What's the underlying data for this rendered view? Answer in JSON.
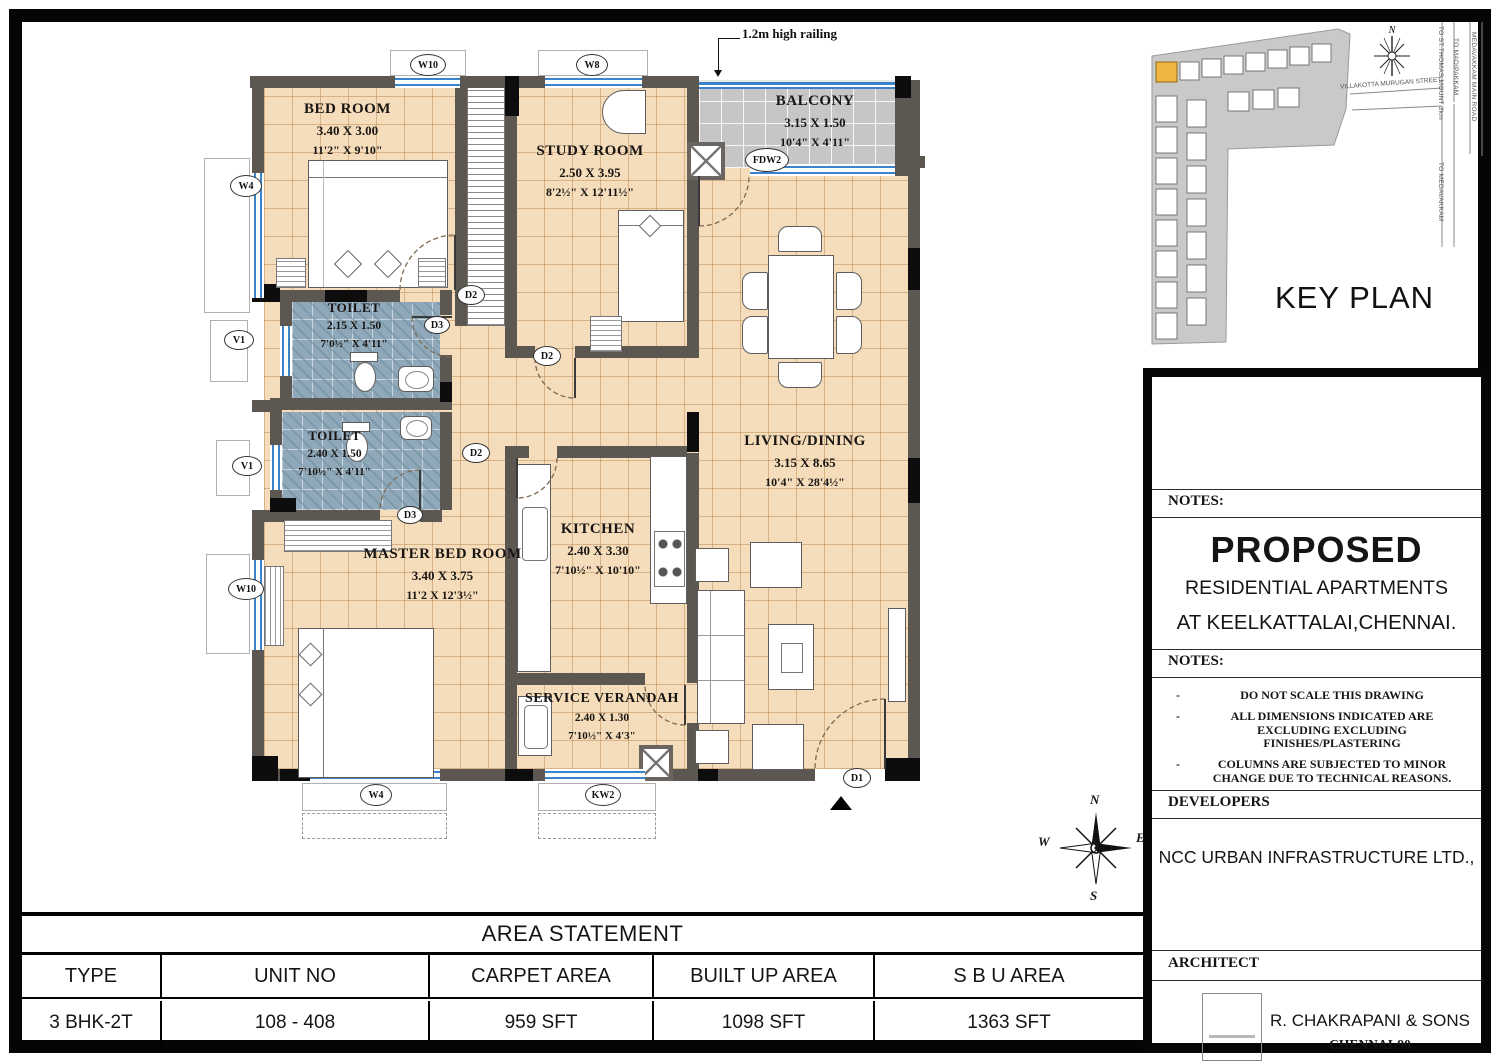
{
  "palette": {
    "floor": "#f5dcbb",
    "toilet_floor": "#8fa9ba",
    "balcony_floor": "#c6c6c6",
    "wall": "#5d5752",
    "window_blue": "#3b84c9",
    "keyplan_highlight": "#f0b440"
  },
  "plan": {
    "railing_note": "1.2m high railing",
    "rooms": {
      "bedroom": {
        "name": "BED ROOM",
        "m": "3.40 X 3.00",
        "ft": "11'2\" X 9'10\""
      },
      "study": {
        "name": "STUDY ROOM",
        "m": "2.50 X 3.95",
        "ft": "8'2½\" X 12'11½\""
      },
      "balcony": {
        "name": "BALCONY",
        "m": "3.15 X 1.50",
        "ft": "10'4\" X 4'11\""
      },
      "toilet1": {
        "name": "TOILET",
        "m": "2.15 X 1.50",
        "ft": "7'0½\" X 4'11\""
      },
      "toilet2": {
        "name": "TOILET",
        "m": "2.40 X 1.50",
        "ft": "7'10½\" X 4'11\""
      },
      "master": {
        "name": "MASTER BED ROOM",
        "m": "3.40 X 3.75",
        "ft": "11'2 X 12'3½\""
      },
      "kitchen": {
        "name": "KITCHEN",
        "m": "2.40 X 3.30",
        "ft": "7'10½\" X 10'10\""
      },
      "verandah": {
        "name": "SERVICE VERANDAH",
        "m": "2.40 X 1.30",
        "ft": "7'10½\" X 4'3\""
      },
      "living": {
        "name": "LIVING/DINING",
        "m": "3.15 X 8.65",
        "ft": "10'4\" X 28'4½\""
      }
    },
    "markers": {
      "w10": "W10",
      "w8": "W8",
      "w4": "W4",
      "v1": "V1",
      "kw2": "KW2",
      "fdw2": "FDW2",
      "d1": "D1",
      "d2": "D2",
      "d3": "D3"
    },
    "compass": {
      "n": "N",
      "e": "E",
      "s": "S",
      "w": "W"
    }
  },
  "key_plan": {
    "title": "KEY PLAN",
    "street": "VILLAKOTTA MURUGAN STREET",
    "road_1": "TO ST.THOMAS MOUNT 2km",
    "road_2": "TO MADIPAKKAM",
    "road_3": "MEDAVAKKAM MAIN ROAD",
    "road_4": "TO MEDAVAKKAM",
    "north": "N"
  },
  "title_block": {
    "notes_label": "NOTES:",
    "project_line1": "PROPOSED",
    "project_line2": "RESIDENTIAL APARTMENTS",
    "project_line3": "AT KEELKATTALAI,CHENNAI.",
    "notes2_label": "NOTES:",
    "notes": [
      "DO NOT SCALE THIS DRAWING",
      "ALL DIMENSIONS INDICATED ARE EXCLUDING EXCLUDING FINISHES/PLASTERING",
      "COLUMNS ARE SUBJECTED TO MINOR CHANGE DUE TO TECHNICAL REASONS."
    ],
    "developers_label": "DEVELOPERS",
    "developer": "NCC URBAN INFRASTRUCTURE LTD.,",
    "architect_label": "ARCHITECT",
    "architect": "R. CHAKRAPANI & SONS",
    "architect_city": "CHENNAI-90"
  },
  "area_statement": {
    "title": "AREA STATEMENT",
    "headers": [
      "TYPE",
      "UNIT NO",
      "CARPET AREA",
      "BUILT UP AREA",
      "S B U AREA"
    ],
    "values": [
      "3 BHK-2T",
      "108 - 408",
      "959 SFT",
      "1098 SFT",
      "1363 SFT"
    ]
  }
}
